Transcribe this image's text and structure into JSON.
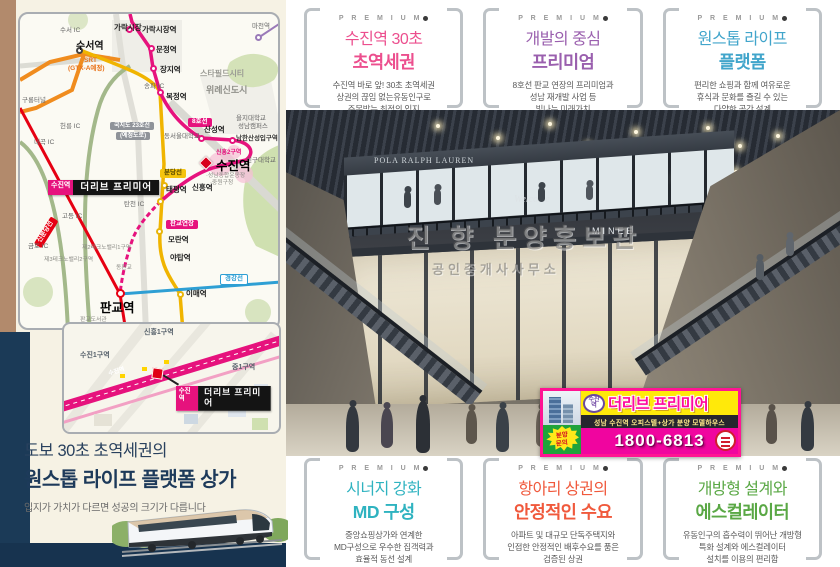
{
  "premium_label": "P R E M I U M",
  "left_panel": {
    "headline": {
      "line1": "도보 30초 초역세권의",
      "line2": "원스톱 라이프 플랫폼 상가",
      "sub": "입지가 가치가 다르면 성공의 크기가 다릅니다"
    },
    "map": {
      "site_label": {
        "tag": "수진역",
        "name": "더리브 프리미어"
      },
      "labels": [
        {
          "x": 40,
          "y": 14,
          "text": "수서 IC",
          "cls": "tiny"
        },
        {
          "x": 56,
          "y": 28,
          "text": "수서역",
          "cls": "st big2"
        },
        {
          "x": 64,
          "y": 44,
          "text": "SRT",
          "cls": "orange"
        },
        {
          "x": 48,
          "y": 52,
          "text": "(GTX-A예정)",
          "cls": "orange"
        },
        {
          "x": 94,
          "y": 10,
          "text": "가락시장",
          "cls": "st"
        },
        {
          "x": 122,
          "y": 12,
          "text": "가락시장역",
          "cls": "st"
        },
        {
          "x": 136,
          "y": 32,
          "text": "문정역",
          "cls": "st"
        },
        {
          "x": 140,
          "y": 52,
          "text": "장지역",
          "cls": "st"
        },
        {
          "x": 180,
          "y": 56,
          "text": "스타필드시티",
          "cls": "gray"
        },
        {
          "x": 124,
          "y": 70,
          "text": "송파 IC",
          "cls": "tiny"
        },
        {
          "x": 146,
          "y": 79,
          "text": "복정역",
          "cls": "st"
        },
        {
          "x": 186,
          "y": 72,
          "text": "위례신도시",
          "cls": "grayb"
        },
        {
          "x": 2,
          "y": 84,
          "text": "구룡터널",
          "cls": "tiny"
        },
        {
          "x": 40,
          "y": 110,
          "text": "헌릉 IC",
          "cls": "tiny"
        },
        {
          "x": 14,
          "y": 126,
          "text": "내곡 IC",
          "cls": "tiny"
        },
        {
          "x": 90,
          "y": 108,
          "text": "국지도 23호선",
          "cls": "badge graybadge"
        },
        {
          "x": 96,
          "y": 118,
          "text": "(예정도로)",
          "cls": "badge graybadge"
        },
        {
          "x": 168,
          "y": 104,
          "text": "8호선",
          "cls": "badge pinkbadge"
        },
        {
          "x": 144,
          "y": 120,
          "text": "동서울대학교",
          "cls": "tiny"
        },
        {
          "x": 216,
          "y": 102,
          "text": "을지대학교",
          "cls": "tiny"
        },
        {
          "x": 218,
          "y": 110,
          "text": "성남캠퍼스",
          "cls": "tiny"
        },
        {
          "x": 184,
          "y": 112,
          "text": "산성역",
          "cls": "st"
        },
        {
          "x": 216,
          "y": 122,
          "text": "남한산성입구역",
          "cls": "dark"
        },
        {
          "x": 196,
          "y": 136,
          "text": "신흥2구역",
          "cls": "pinktxt"
        },
        {
          "x": 226,
          "y": 144,
          "text": "신구대학교",
          "cls": "tiny"
        },
        {
          "x": 196,
          "y": 146,
          "text": "수진역",
          "cls": "huge"
        },
        {
          "x": 186,
          "y": 160,
          "text": "·성남종합운동장",
          "cls": "micro"
        },
        {
          "x": 190,
          "y": 167,
          "text": "·중원구청",
          "cls": "micro"
        },
        {
          "x": 140,
          "y": 155,
          "text": "분당선",
          "cls": "badge yellowbadge"
        },
        {
          "x": 146,
          "y": 172,
          "text": "태평역",
          "cls": "st"
        },
        {
          "x": 172,
          "y": 170,
          "text": "신흥역",
          "cls": "st"
        },
        {
          "x": 104,
          "y": 188,
          "text": "탄천 IC",
          "cls": "tiny"
        },
        {
          "x": 42,
          "y": 200,
          "text": "고등 IC",
          "cls": "tiny"
        },
        {
          "x": 146,
          "y": 206,
          "text": "판교연장",
          "cls": "badge pinkbadge"
        },
        {
          "x": 148,
          "y": 222,
          "text": "모란역",
          "cls": "st"
        },
        {
          "x": 10,
          "y": 214,
          "text": "신분당선",
          "cls": "badge redbadge rot"
        },
        {
          "x": 8,
          "y": 230,
          "text": "금토 IC",
          "cls": "tiny"
        },
        {
          "x": 62,
          "y": 232,
          "text": "제2테크노밸리1구역",
          "cls": "micro"
        },
        {
          "x": 24,
          "y": 244,
          "text": "제3테크노밸리2구역",
          "cls": "micro"
        },
        {
          "x": 96,
          "y": 252,
          "text": "동판교",
          "cls": "micro"
        },
        {
          "x": 150,
          "y": 240,
          "text": "야탑역",
          "cls": "st"
        },
        {
          "x": 200,
          "y": 260,
          "text": "경강선",
          "cls": "badge bluebadge"
        },
        {
          "x": 166,
          "y": 276,
          "text": "이매역",
          "cls": "st"
        },
        {
          "x": 80,
          "y": 288,
          "text": "판교역",
          "cls": "huge"
        },
        {
          "x": 60,
          "y": 304,
          "text": "판교도서관",
          "cls": "micro"
        },
        {
          "x": 232,
          "y": 10,
          "text": "마천역",
          "cls": "tiny"
        }
      ],
      "dots": [
        {
          "x": 106,
          "y": 12,
          "cls": "pink"
        },
        {
          "x": 128,
          "y": 31,
          "cls": "pink"
        },
        {
          "x": 130,
          "y": 51,
          "cls": "pink"
        },
        {
          "x": 137,
          "y": 75,
          "cls": "pink"
        },
        {
          "x": 178,
          "y": 121,
          "cls": "pink"
        },
        {
          "x": 209,
          "y": 123,
          "cls": "pink"
        },
        {
          "x": 141,
          "y": 168,
          "cls": "yellow"
        },
        {
          "x": 137,
          "y": 184,
          "cls": "yellow"
        },
        {
          "x": 136,
          "y": 214,
          "cls": "yellow"
        },
        {
          "x": 157,
          "y": 277,
          "cls": "yellow"
        },
        {
          "x": 96,
          "y": 275,
          "cls": "red big"
        },
        {
          "x": 235,
          "y": 20,
          "cls": "purple"
        },
        {
          "x": 56,
          "y": 33,
          "cls": "darkd"
        }
      ],
      "inset": {
        "zones": [
          {
            "x": 80,
            "y": 3,
            "text": "신흥1구역",
            "cls": ""
          },
          {
            "x": 16,
            "y": 26,
            "text": "수진1구역",
            "cls": ""
          },
          {
            "x": 168,
            "y": 38,
            "text": "중1구역",
            "cls": ""
          }
        ],
        "road_station": "수진역"
      }
    }
  },
  "premium_top": [
    {
      "t1": "수진역 30초",
      "t2": "초역세권",
      "d1": "수진역 바로 앞! 30초 초역세권",
      "d2": "상권의 끊임 없는유동인구로",
      "d3": "주목받는 최적의 입지",
      "accent": "#ec4f8e"
    },
    {
      "t1": "개발의 중심",
      "t2": "프리미엄",
      "d1": "8호선 판교 연장의 프리미엄과",
      "d2": "성남 재개발 사업 등",
      "d3": "빛나는 미래가치",
      "accent": "#9a5fae"
    },
    {
      "t1": "원스톱 라이프",
      "t2": "플랫폼",
      "d1": "편리한 쇼핑과 함께 여유로운",
      "d2": "휴식과 문화를 즐길 수 있는",
      "d3": "다양한 공간 설계",
      "accent": "#41a5cb"
    }
  ],
  "premium_bottom": [
    {
      "t1": "시너지 강화",
      "t2": "MD 구성",
      "d1": "중앙쇼핑상가와 연계한",
      "d2": "MD구성으로 우수한 집객력과",
      "d3": "효율적 동선 설계",
      "accent": "#2fb3c0"
    },
    {
      "t1": "항아리 상권의",
      "t2": "안정적인 수요",
      "d1": "아파트 및 대규모 단독주택지와",
      "d2": "인접한 안정적인 배후수요를 품은",
      "d3": "검증된 상권",
      "accent": "#f0593c"
    },
    {
      "t1": "개방형 설계와",
      "t2": "에스컬레이터",
      "d1": "유동인구의 흡수력이 뛰어난 개방형",
      "d2": "특화 설계와 에스컬레이터",
      "d3": "설치를 이용의 편리함",
      "accent": "#5aa845"
    }
  ],
  "photo": {
    "signs": [
      {
        "x": 88,
        "y": 46,
        "text": "POLA RALPH LAUREN",
        "cls": "s1"
      },
      {
        "x": 228,
        "y": 84,
        "text": "Welcome",
        "cls": "s2"
      },
      {
        "x": 306,
        "y": 116,
        "text": "MINEE",
        "cls": "s3"
      }
    ],
    "watermark1": "진 향 분양홍보관",
    "watermark2": "공인중개사사무소"
  },
  "banner": {
    "station_tag1": "수진",
    "station_tag2": "역",
    "brand": "더리브 프리미어",
    "strip": "성남 수진역 오피스텔+상가 분양 모델하우스",
    "inquiry1": "분양",
    "inquiry2": "문의",
    "phone": "1800-6813"
  }
}
